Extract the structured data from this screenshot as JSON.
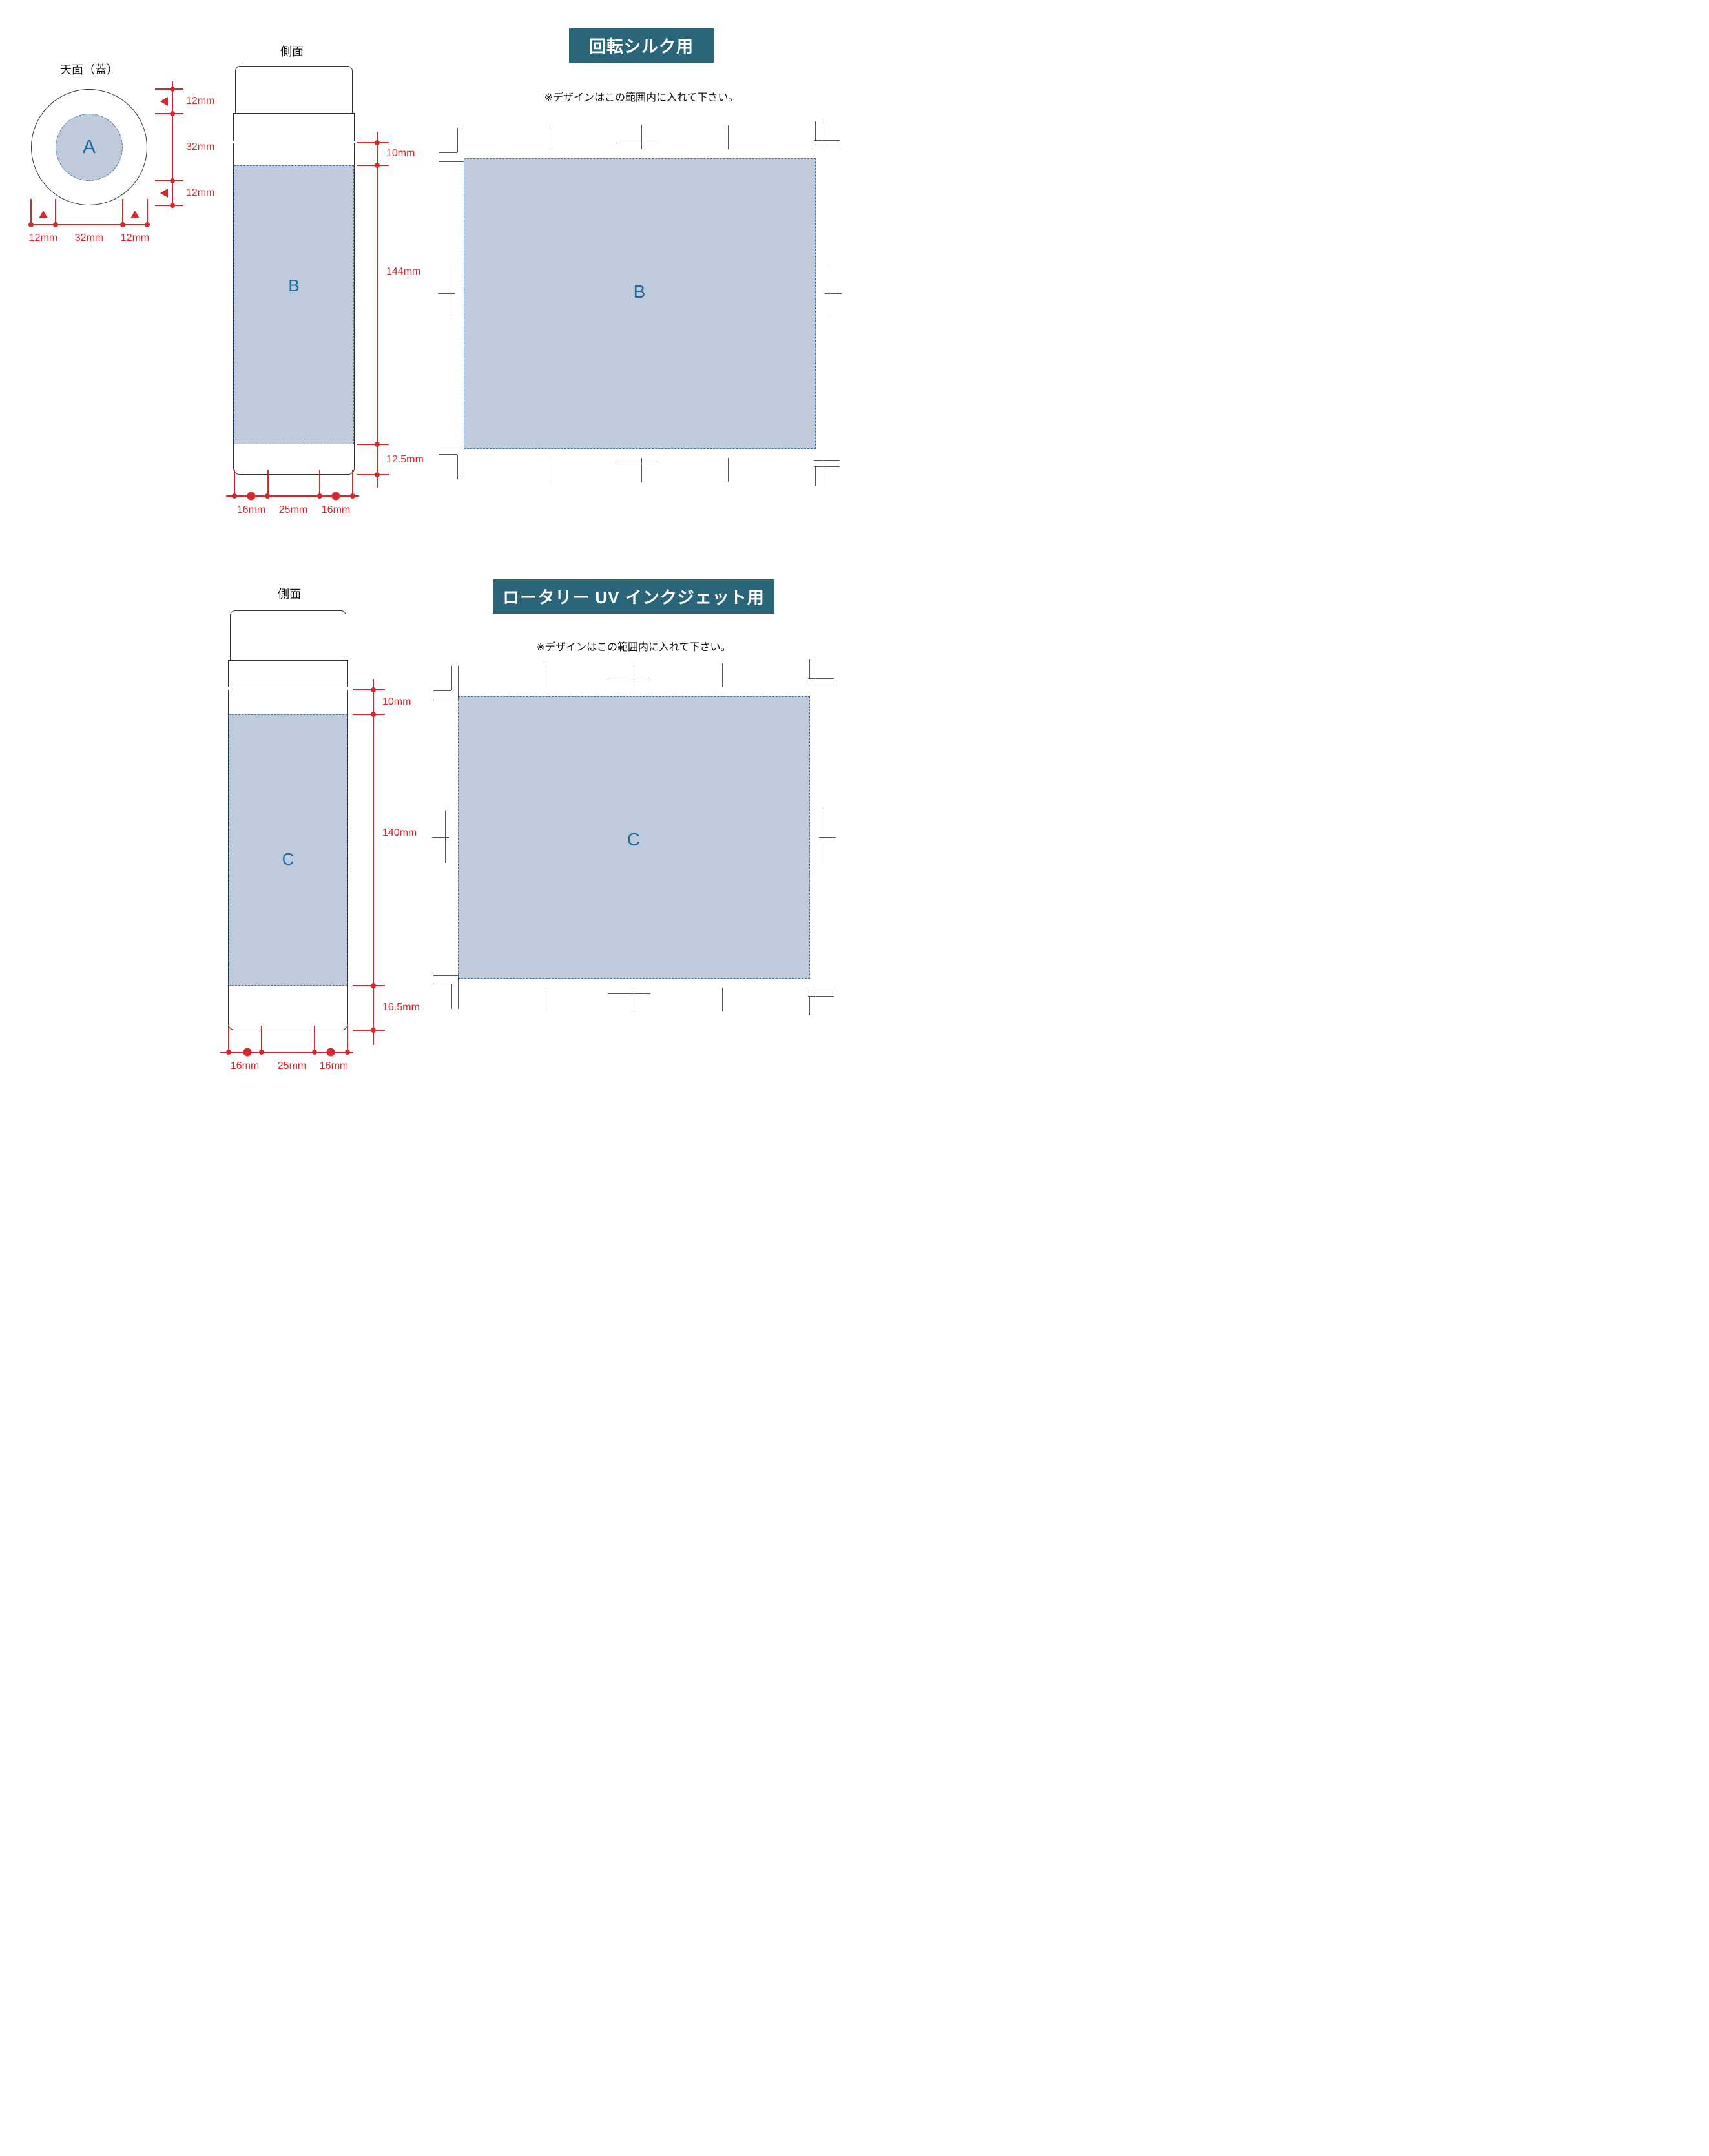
{
  "colors": {
    "red_dimension": "#d7282e",
    "blue_letter": "#176ba6",
    "print_area_fill": "#bfcada",
    "print_area_dash": "#3b74a6",
    "badge_background": "#2a6579",
    "outline": "#333333"
  },
  "sections": [
    {
      "badge": "回転シルク用",
      "note": "※デザインはこの範囲内に入れて下さい。",
      "top_view": {
        "title": "天面（蓋）",
        "area_label": "A",
        "vertical_dims": [
          "12mm",
          "32mm",
          "12mm"
        ],
        "horizontal_dims": [
          "12mm",
          "32mm",
          "12mm"
        ]
      },
      "side_view": {
        "title": "側面",
        "area_label": "B",
        "top_margin": "10mm",
        "print_height": "144mm",
        "bottom_margin": "12.5mm",
        "bottom_dims": [
          "16mm",
          "25mm",
          "16mm"
        ]
      },
      "unrolled": {
        "area_label": "B"
      }
    },
    {
      "badge": "ロータリー UV インクジェット用",
      "note": "※デザインはこの範囲内に入れて下さい。",
      "side_view": {
        "title": "側面",
        "area_label": "C",
        "top_margin": "10mm",
        "print_height": "140mm",
        "bottom_margin": "16.5mm",
        "bottom_dims": [
          "16mm",
          "25mm",
          "16mm"
        ]
      },
      "unrolled": {
        "area_label": "C"
      }
    }
  ]
}
